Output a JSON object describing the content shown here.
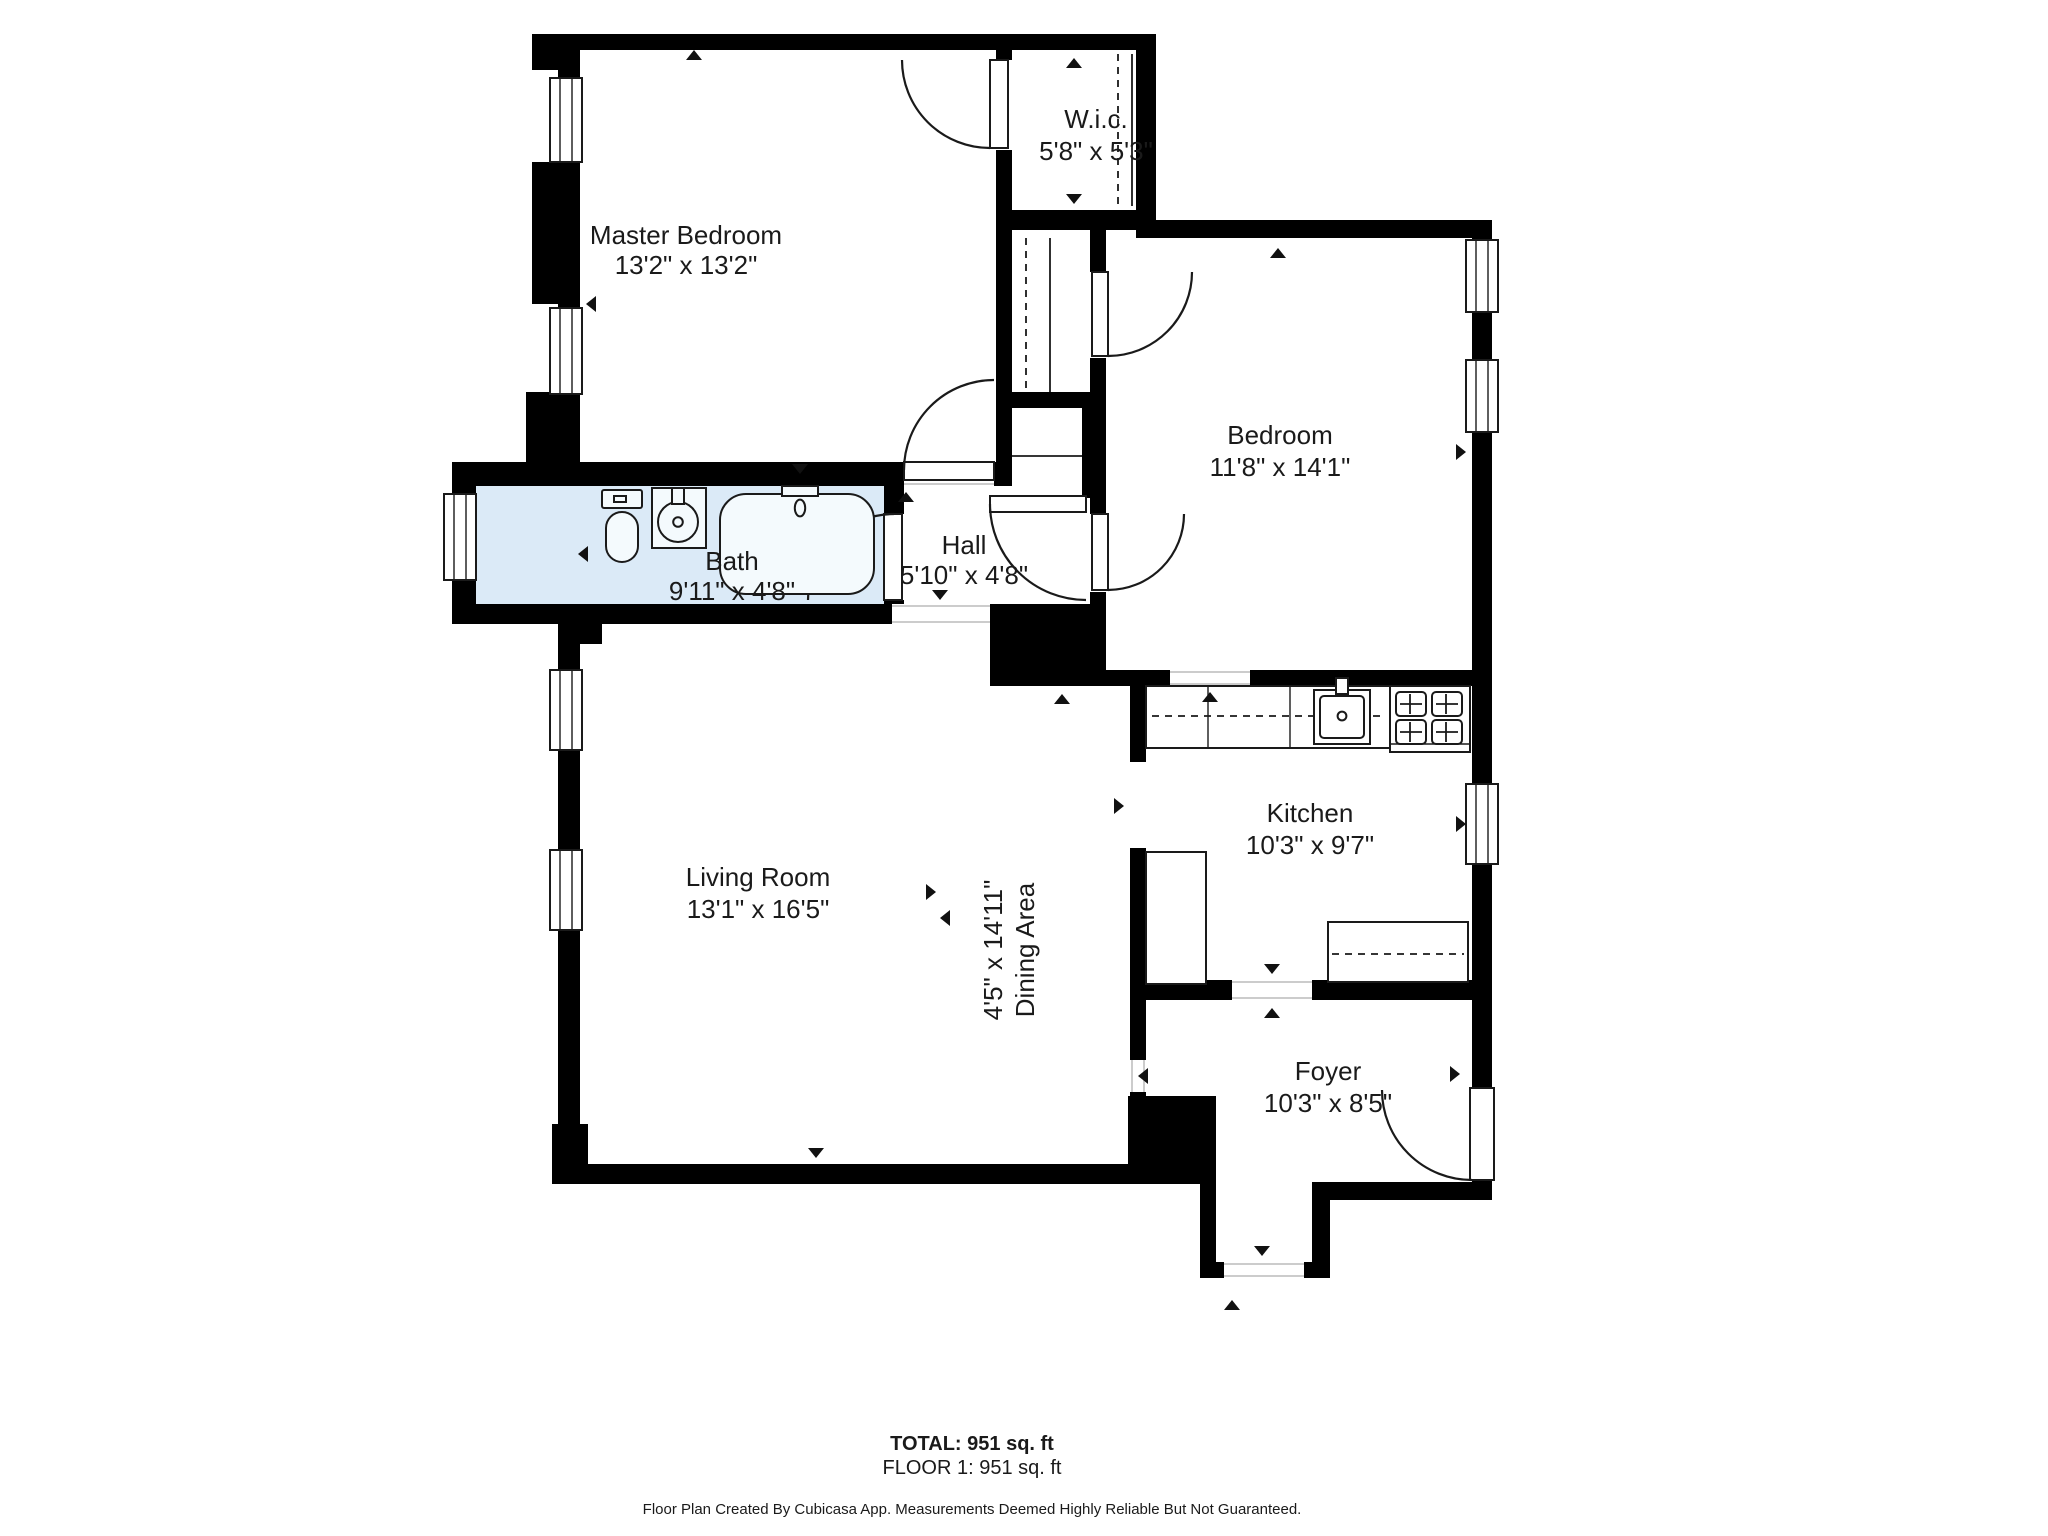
{
  "rooms": [
    {
      "name": "Master Bedroom",
      "dims": "13'2\" x 13'2\""
    },
    {
      "name": "W.i.c.",
      "dims": "5'8\" x 5'3\""
    },
    {
      "name": "Bedroom",
      "dims": "11'8\" x 14'1\""
    },
    {
      "name": "Bath",
      "dims": "9'11\" x 4'8\""
    },
    {
      "name": "Hall",
      "dims": "5'10\" x 4'8\""
    },
    {
      "name": "Living Room",
      "dims": "13'1\" x 16'5\""
    },
    {
      "name": "Dining Area",
      "dims": "4'5\" x 14'11\""
    },
    {
      "name": "Kitchen",
      "dims": "10'3\" x 9'7\""
    },
    {
      "name": "Foyer",
      "dims": "10'3\" x 8'5\""
    }
  ],
  "footer": {
    "total": "TOTAL: 951 sq. ft",
    "floor": "FLOOR 1: 951 sq. ft",
    "disclaimer": "Floor Plan Created By Cubicasa App. Measurements Deemed Highly Reliable But Not Guaranteed."
  },
  "colors": {
    "wall": "#000000",
    "bath_floor": "#dbeaf7",
    "floor": "#ffffff"
  }
}
